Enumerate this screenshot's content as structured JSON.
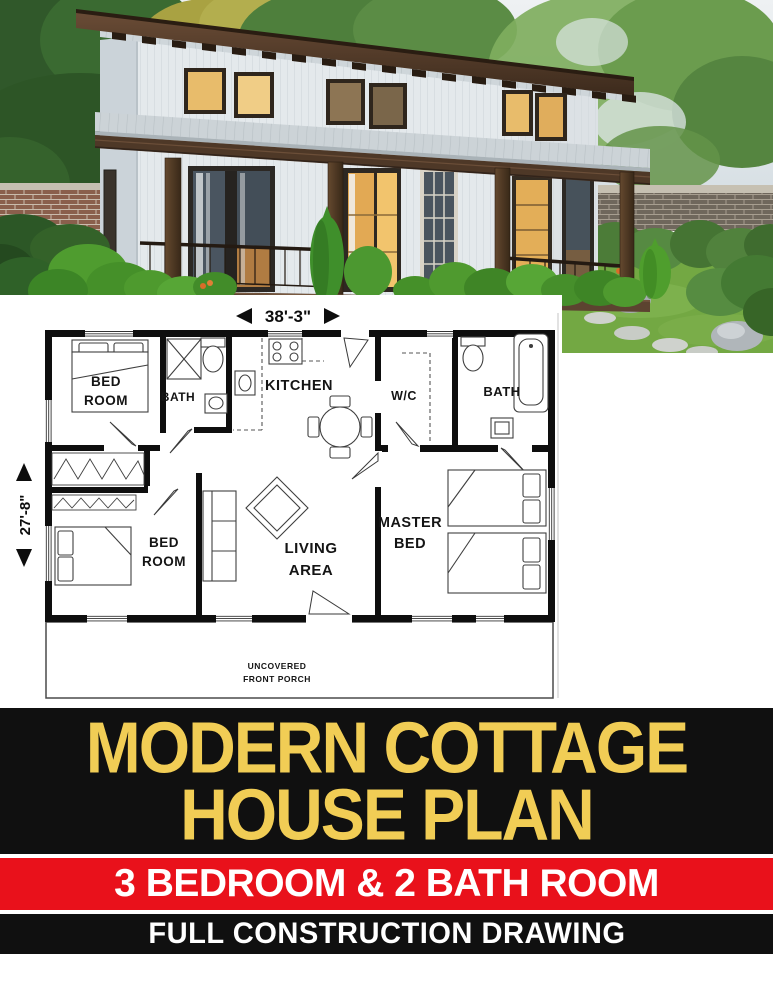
{
  "plan": {
    "dim_width": "38'-3\"",
    "dim_height": "27'-8\"",
    "rooms": {
      "bedroom_top": {
        "l1": "BED",
        "l2": "ROOM"
      },
      "bath_left": "BATH",
      "kitchen": "KITCHEN",
      "wc": "W/C",
      "bath_right": "BATH",
      "bedroom_bottom": {
        "l1": "BED",
        "l2": "ROOM"
      },
      "living": {
        "l1": "LIVING",
        "l2": "AREA"
      },
      "master": {
        "l1": "MASTER",
        "l2": "BED"
      },
      "porch": {
        "l1": "UNCOVERED",
        "l2": "FRONT PORCH"
      }
    }
  },
  "banners": {
    "title": {
      "line1": "MODERN COTTAGE",
      "line2": "HOUSE PLAN",
      "bg": "#101010",
      "fg": "#f1cd55"
    },
    "subtitle": {
      "text": "3 BEDROOM & 2 BATH ROOM",
      "bg": "#e9111b",
      "fg": "#ffffff"
    },
    "tagline": {
      "text": "FULL CONSTRUCTION DRAWING",
      "bg": "#101010",
      "fg": "#ffffff"
    }
  },
  "photo_palette": {
    "grass": "#73a843",
    "foliage": "#4f8040",
    "siding": "#e4e9ec",
    "roof_wood": "#4e3827",
    "window_glow": "#e8bc6b"
  }
}
